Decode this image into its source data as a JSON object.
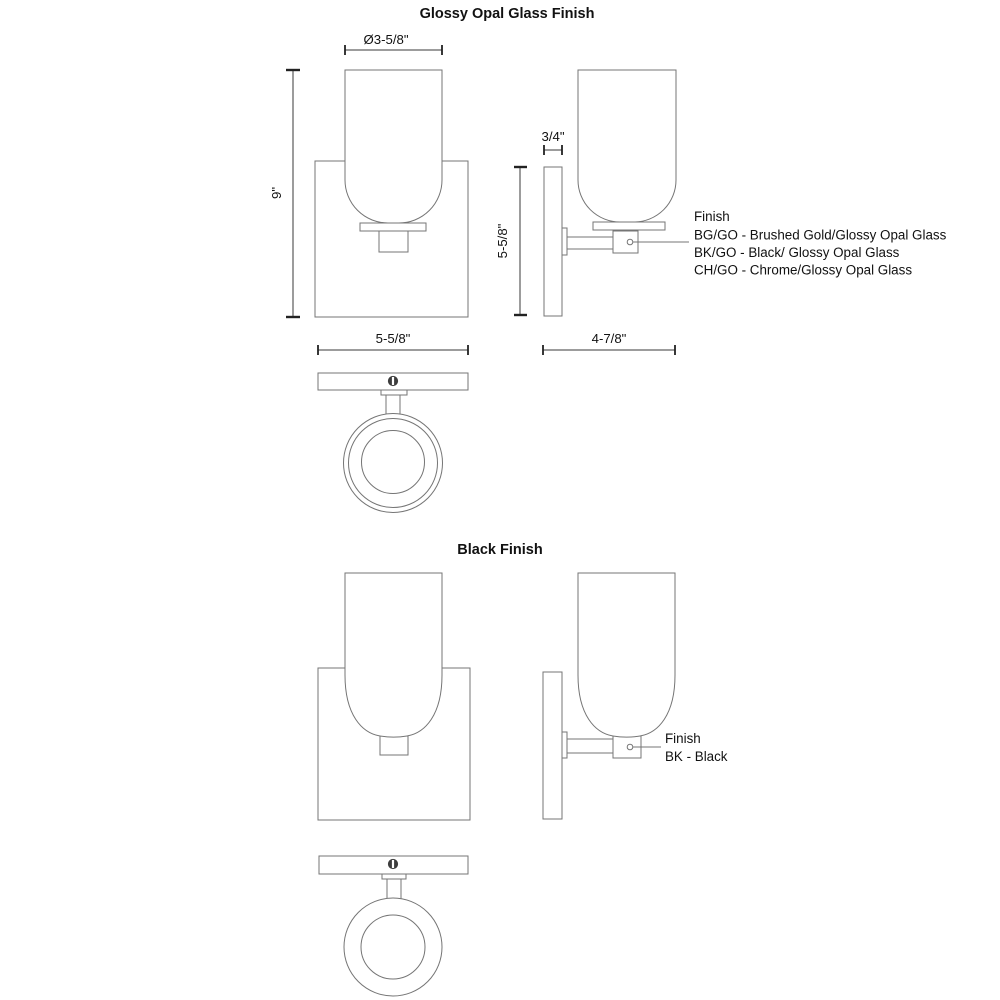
{
  "page": {
    "background": "#ffffff",
    "drawing_line_color": "#757575",
    "dimension_line_color": "#3a3a3a",
    "text_color": "#111111"
  },
  "sections": [
    {
      "title": "Glossy Opal Glass Finish",
      "dimensions": {
        "shade_diameter": "Ø3-5/8\"",
        "overall_height": "9\"",
        "backplate_width": "5-5/8\"",
        "backplate_height": "5-5/8\"",
        "backplate_thickness": "3/4\"",
        "extension_depth": "4-7/8\""
      },
      "finish_legend": {
        "label": "Finish",
        "options": [
          "BG/GO - Brushed Gold/Glossy Opal Glass",
          "BK/GO - Black/ Glossy Opal Glass",
          "CH/GO - Chrome/Glossy Opal Glass"
        ]
      }
    },
    {
      "title": "Black Finish",
      "finish_legend": {
        "label": "Finish",
        "options": [
          "BK - Black"
        ]
      }
    }
  ]
}
